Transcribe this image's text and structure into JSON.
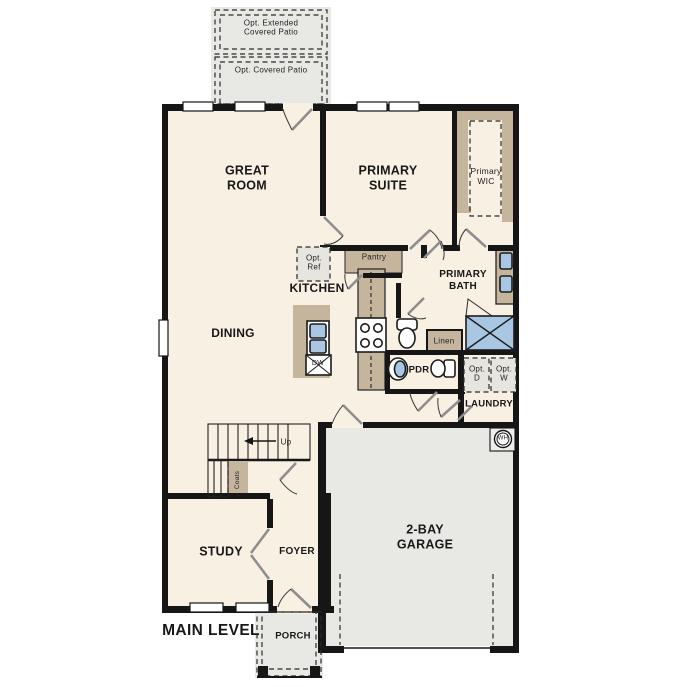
{
  "title": "Main level floor plan",
  "labels": {
    "patio_extended": "Opt. Extended\nCovered Patio",
    "patio_covered": "Opt. Covered Patio",
    "great_room": "GREAT\nROOM",
    "primary_suite": "PRIMARY\nSUITE",
    "primary_wic": "Primary\nWIC",
    "kitchen": "KITCHEN",
    "pantry": "Pantry",
    "opt_ref": "Opt.\nRef",
    "dining": "DINING",
    "primary_bath": "PRIMARY\nBATH",
    "linen": "Linen",
    "pdr": "PDR",
    "opt_dryer": "Opt.\nD",
    "opt_washer": "Opt.\nW",
    "laundry": "LAUNDRY",
    "up": "Up",
    "coats": "Coats",
    "dw": "DW",
    "wh": "WH",
    "study": "STUDY",
    "foyer": "FOYER",
    "garage": "2-BAY\nGARAGE",
    "porch": "PORCH",
    "main_level": "MAIN LEVEL"
  },
  "colors": {
    "wall": "#161616",
    "floor": "#f7f0e3",
    "gfloor": "#e8e8e5",
    "tan": "#c6b59d",
    "blue": "#a9c7e3",
    "opt": "#e7e5e0"
  }
}
